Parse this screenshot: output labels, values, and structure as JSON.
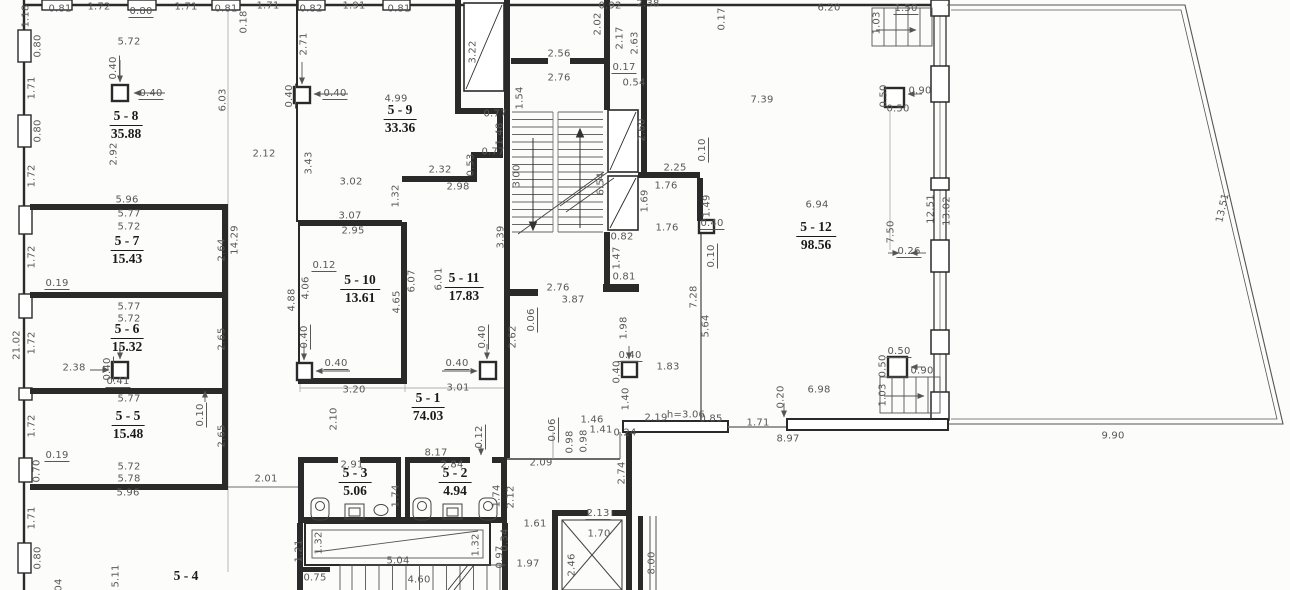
{
  "colors": {
    "wall": "#2a2a2a",
    "thin_line": "#777777",
    "dim_line": "#9a9a9a",
    "dim_text": "#585858",
    "room_text": "#1b1b1b",
    "paper": "#fcfcfa"
  },
  "rooms": [
    {
      "id": "5 - 8",
      "area": "35.88",
      "x": 126,
      "y": 117
    },
    {
      "id": "5 - 9",
      "area": "33.36",
      "x": 400,
      "y": 111
    },
    {
      "id": "5 - 7",
      "area": "15.43",
      "x": 127,
      "y": 242
    },
    {
      "id": "5 - 10",
      "area": "13.61",
      "x": 360,
      "y": 281
    },
    {
      "id": "5 - 11",
      "area": "17.83",
      "x": 464,
      "y": 279
    },
    {
      "id": "5 - 12",
      "area": "98.56",
      "x": 816,
      "y": 228
    },
    {
      "id": "5 - 6",
      "area": "15.32",
      "x": 127,
      "y": 330
    },
    {
      "id": "5 - 5",
      "area": "15.48",
      "x": 128,
      "y": 417
    },
    {
      "id": "5 - 1",
      "area": "74.03",
      "x": 428,
      "y": 399
    },
    {
      "id": "5 - 3",
      "area": "5.06",
      "x": 355,
      "y": 474
    },
    {
      "id": "5 - 2",
      "area": "4.94",
      "x": 455,
      "y": 474
    },
    {
      "id": "5 - 4",
      "area": "",
      "x": 186,
      "y": 577
    }
  ],
  "dimensions": [
    {
      "t": "1.18",
      "x": 26,
      "y": 16,
      "r": 1
    },
    {
      "t": "0.81",
      "x": 60,
      "y": 9
    },
    {
      "t": "1.72",
      "x": 99,
      "y": 7
    },
    {
      "t": "0.80",
      "x": 141,
      "y": 12,
      "u": 1
    },
    {
      "t": "1.71",
      "x": 186,
      "y": 7
    },
    {
      "t": "0.81",
      "x": 226,
      "y": 9
    },
    {
      "t": "0.18",
      "x": 244,
      "y": 22,
      "r": 1
    },
    {
      "t": "1.71",
      "x": 268,
      "y": 6
    },
    {
      "t": "0.82",
      "x": 311,
      "y": 9
    },
    {
      "t": "1.91",
      "x": 354,
      "y": 6
    },
    {
      "t": "0.81",
      "x": 399,
      "y": 9
    },
    {
      "t": "2.71",
      "x": 304,
      "y": 44,
      "r": 1
    },
    {
      "t": "5.72",
      "x": 129,
      "y": 42
    },
    {
      "t": "0.80",
      "x": 38,
      "y": 46,
      "r": 1
    },
    {
      "t": "0.40",
      "x": 114,
      "y": 68,
      "r": 1,
      "u": 1
    },
    {
      "t": "0.40",
      "x": 151,
      "y": 94,
      "u": 1
    },
    {
      "t": "1.71",
      "x": 32,
      "y": 88,
      "r": 1
    },
    {
      "t": "6.03",
      "x": 223,
      "y": 100,
      "r": 1
    },
    {
      "t": "0.40",
      "x": 290,
      "y": 96,
      "r": 1,
      "u": 1
    },
    {
      "t": "0.40",
      "x": 335,
      "y": 94,
      "u": 1
    },
    {
      "t": "4.99",
      "x": 396,
      "y": 99
    },
    {
      "t": "0.80",
      "x": 38,
      "y": 131,
      "r": 1
    },
    {
      "t": "2.92",
      "x": 114,
      "y": 154,
      "r": 1
    },
    {
      "t": "1.72",
      "x": 32,
      "y": 176,
      "r": 1
    },
    {
      "t": "2.12",
      "x": 264,
      "y": 154
    },
    {
      "t": "3.43",
      "x": 309,
      "y": 163,
      "r": 1
    },
    {
      "t": "3.02",
      "x": 351,
      "y": 182
    },
    {
      "t": "5.96",
      "x": 127,
      "y": 200
    },
    {
      "t": "5.77",
      "x": 129,
      "y": 214
    },
    {
      "t": "5.72",
      "x": 129,
      "y": 227
    },
    {
      "t": "3.07",
      "x": 350,
      "y": 216
    },
    {
      "t": "2.95",
      "x": 353,
      "y": 231
    },
    {
      "t": "1.32",
      "x": 396,
      "y": 196,
      "r": 1
    },
    {
      "t": "2.32",
      "x": 440,
      "y": 170
    },
    {
      "t": "2.98",
      "x": 458,
      "y": 187
    },
    {
      "t": "0.77",
      "x": 495,
      "y": 114
    },
    {
      "t": "1.48",
      "x": 500,
      "y": 134,
      "r": 1
    },
    {
      "t": "0.77",
      "x": 493,
      "y": 152
    },
    {
      "t": "0.53",
      "x": 471,
      "y": 165,
      "r": 1
    },
    {
      "t": "3.22",
      "x": 473,
      "y": 52,
      "r": 1
    },
    {
      "t": "1.54",
      "x": 520,
      "y": 98,
      "r": 1
    },
    {
      "t": "2.56",
      "x": 559,
      "y": 54
    },
    {
      "t": "2.76",
      "x": 559,
      "y": 78
    },
    {
      "t": "3.00",
      "x": 517,
      "y": 176,
      "r": 1
    },
    {
      "t": "6.54",
      "x": 601,
      "y": 184,
      "r": 1
    },
    {
      "t": "0.92",
      "x": 610,
      "y": 6
    },
    {
      "t": "2.02",
      "x": 598,
      "y": 24,
      "r": 1
    },
    {
      "t": "2.38",
      "x": 648,
      "y": 4
    },
    {
      "t": "2.17",
      "x": 620,
      "y": 38,
      "r": 1
    },
    {
      "t": "2.63",
      "x": 635,
      "y": 43,
      "r": 1
    },
    {
      "t": "0.17",
      "x": 624,
      "y": 68,
      "u": 1
    },
    {
      "t": "0.54",
      "x": 634,
      "y": 83
    },
    {
      "t": "2.60",
      "x": 642,
      "y": 130,
      "r": 1
    },
    {
      "t": "1.69",
      "x": 645,
      "y": 201,
      "r": 1
    },
    {
      "t": "2.25",
      "x": 675,
      "y": 168
    },
    {
      "t": "1.76",
      "x": 666,
      "y": 186
    },
    {
      "t": "1.76",
      "x": 667,
      "y": 228
    },
    {
      "t": "0.10",
      "x": 703,
      "y": 150,
      "r": 1,
      "u": 1
    },
    {
      "t": "1.49",
      "x": 707,
      "y": 206,
      "r": 1
    },
    {
      "t": "0.40",
      "x": 712,
      "y": 224,
      "u": 1
    },
    {
      "t": "0.10",
      "x": 712,
      "y": 256,
      "r": 1,
      "u": 1
    },
    {
      "t": "0.82",
      "x": 622,
      "y": 237
    },
    {
      "t": "1.47",
      "x": 617,
      "y": 258,
      "r": 1
    },
    {
      "t": "0.81",
      "x": 624,
      "y": 277
    },
    {
      "t": "2.76",
      "x": 558,
      "y": 288
    },
    {
      "t": "3.87",
      "x": 573,
      "y": 300
    },
    {
      "t": "0.06",
      "x": 532,
      "y": 320,
      "r": 1,
      "u": 1
    },
    {
      "t": "2.62",
      "x": 513,
      "y": 337,
      "r": 1
    },
    {
      "t": "7.28",
      "x": 694,
      "y": 297,
      "r": 1
    },
    {
      "t": "5.64",
      "x": 706,
      "y": 326,
      "r": 1
    },
    {
      "t": "1.98",
      "x": 624,
      "y": 328,
      "r": 1
    },
    {
      "t": "0.17",
      "x": 722,
      "y": 19,
      "r": 1
    },
    {
      "t": "6.20",
      "x": 829,
      "y": 8
    },
    {
      "t": "1.50",
      "x": 906,
      "y": 9,
      "u": 1
    },
    {
      "t": "1.03",
      "x": 877,
      "y": 23,
      "r": 1
    },
    {
      "t": "7.39",
      "x": 762,
      "y": 100
    },
    {
      "t": "0.50",
      "x": 884,
      "y": 96,
      "r": 1
    },
    {
      "t": "0.90",
      "x": 920,
      "y": 91
    },
    {
      "t": "0.50",
      "x": 898,
      "y": 109
    },
    {
      "t": "6.94",
      "x": 817,
      "y": 205
    },
    {
      "t": "7.50",
      "x": 891,
      "y": 232,
      "r": 1
    },
    {
      "t": "12.51",
      "x": 931,
      "y": 209,
      "r": 1
    },
    {
      "t": "13.02",
      "x": 947,
      "y": 211,
      "r": 1
    },
    {
      "t": "0.26",
      "x": 909,
      "y": 252,
      "u": 1
    },
    {
      "t": "13.51",
      "x": 1223,
      "y": 208,
      "r": -77
    },
    {
      "t": "0.19",
      "x": 57,
      "y": 284,
      "u": 1
    },
    {
      "t": "5.77",
      "x": 129,
      "y": 307
    },
    {
      "t": "5.72",
      "x": 129,
      "y": 319
    },
    {
      "t": "2.64",
      "x": 222,
      "y": 250,
      "r": 1
    },
    {
      "t": "14.29",
      "x": 235,
      "y": 240,
      "r": 1
    },
    {
      "t": "1.72",
      "x": 32,
      "y": 257,
      "r": 1
    },
    {
      "t": "21.02",
      "x": 17,
      "y": 345,
      "r": 1
    },
    {
      "t": "1.72",
      "x": 32,
      "y": 343,
      "r": 1
    },
    {
      "t": "2.38",
      "x": 74,
      "y": 368
    },
    {
      "t": "0.40",
      "x": 108,
      "y": 369,
      "r": 1,
      "u": 1
    },
    {
      "t": "0.41",
      "x": 118,
      "y": 382,
      "u": 1
    },
    {
      "t": "2.65",
      "x": 222,
      "y": 339,
      "r": 1
    },
    {
      "t": "0.12",
      "x": 324,
      "y": 266,
      "u": 1
    },
    {
      "t": "4.06",
      "x": 306,
      "y": 288,
      "r": 1
    },
    {
      "t": "4.88",
      "x": 292,
      "y": 300,
      "r": 1
    },
    {
      "t": "4.65",
      "x": 397,
      "y": 302,
      "r": 1
    },
    {
      "t": "6.07",
      "x": 412,
      "y": 281,
      "r": 1
    },
    {
      "t": "6.01",
      "x": 439,
      "y": 279,
      "r": 1
    },
    {
      "t": "3.39",
      "x": 501,
      "y": 237,
      "r": 1
    },
    {
      "t": "0.40",
      "x": 305,
      "y": 337,
      "r": 1,
      "u": 1
    },
    {
      "t": "0.40",
      "x": 336,
      "y": 364,
      "u": 1
    },
    {
      "t": "0.40",
      "x": 483,
      "y": 337,
      "r": 1,
      "u": 1
    },
    {
      "t": "0.40",
      "x": 457,
      "y": 364,
      "u": 1
    },
    {
      "t": "0.40",
      "x": 630,
      "y": 356,
      "u": 1
    },
    {
      "t": "0.40",
      "x": 617,
      "y": 372,
      "r": 1
    },
    {
      "t": "1.83",
      "x": 668,
      "y": 367
    },
    {
      "t": "3.20",
      "x": 354,
      "y": 390
    },
    {
      "t": "3.01",
      "x": 458,
      "y": 388
    },
    {
      "t": "2.10",
      "x": 334,
      "y": 419,
      "r": 1
    },
    {
      "t": "1.40",
      "x": 626,
      "y": 399,
      "r": 1
    },
    {
      "t": "5.77",
      "x": 129,
      "y": 399
    },
    {
      "t": "0.10",
      "x": 201,
      "y": 415,
      "r": 1,
      "u": 1
    },
    {
      "t": "2.65",
      "x": 222,
      "y": 436,
      "r": 1
    },
    {
      "t": "1.72",
      "x": 32,
      "y": 426,
      "r": 1
    },
    {
      "t": "0.19",
      "x": 57,
      "y": 456,
      "u": 1
    },
    {
      "t": "0.70",
      "x": 37,
      "y": 471,
      "r": 1
    },
    {
      "t": "5.72",
      "x": 129,
      "y": 467
    },
    {
      "t": "5.78",
      "x": 129,
      "y": 479
    },
    {
      "t": "5.96",
      "x": 128,
      "y": 493
    },
    {
      "t": "2.01",
      "x": 266,
      "y": 479
    },
    {
      "t": "1.46",
      "x": 592,
      "y": 420
    },
    {
      "t": "1.41",
      "x": 601,
      "y": 430
    },
    {
      "t": "0.24",
      "x": 625,
      "y": 433
    },
    {
      "t": "0.98",
      "x": 570,
      "y": 442,
      "r": 1
    },
    {
      "t": "0.98",
      "x": 584,
      "y": 441,
      "r": 1
    },
    {
      "t": "0.06",
      "x": 553,
      "y": 430,
      "r": 1,
      "u": 1
    },
    {
      "t": "2.19",
      "x": 656,
      "y": 418
    },
    {
      "t": "h=3.06",
      "x": 686,
      "y": 415
    },
    {
      "t": "0.85",
      "x": 711,
      "y": 419
    },
    {
      "t": "1.71",
      "x": 758,
      "y": 423
    },
    {
      "t": "8.97",
      "x": 788,
      "y": 439
    },
    {
      "t": "0.20",
      "x": 781,
      "y": 397,
      "r": 1
    },
    {
      "t": "6.98",
      "x": 819,
      "y": 390
    },
    {
      "t": "0.50",
      "x": 899,
      "y": 352,
      "u": 1
    },
    {
      "t": "0.50",
      "x": 883,
      "y": 366,
      "r": 1
    },
    {
      "t": "0.90",
      "x": 922,
      "y": 371
    },
    {
      "t": "1.03",
      "x": 883,
      "y": 395,
      "r": 1
    },
    {
      "t": "9.90",
      "x": 1113,
      "y": 436
    },
    {
      "t": "8.17",
      "x": 436,
      "y": 453
    },
    {
      "t": "0.12",
      "x": 480,
      "y": 437,
      "r": 1,
      "u": 1
    },
    {
      "t": "2.09",
      "x": 541,
      "y": 463
    },
    {
      "t": "2.91",
      "x": 352,
      "y": 465
    },
    {
      "t": "2.84",
      "x": 452,
      "y": 465
    },
    {
      "t": "1.74",
      "x": 396,
      "y": 496,
      "r": 1
    },
    {
      "t": "1.74",
      "x": 497,
      "y": 496,
      "r": 1
    },
    {
      "t": "2.12",
      "x": 511,
      "y": 497,
      "r": 1
    },
    {
      "t": "2.74",
      "x": 622,
      "y": 473,
      "r": 1
    },
    {
      "t": "1.61",
      "x": 535,
      "y": 524
    },
    {
      "t": "2.13",
      "x": 598,
      "y": 514,
      "u": 1
    },
    {
      "t": "1.70",
      "x": 599,
      "y": 534
    },
    {
      "t": "0.34",
      "x": 505,
      "y": 540,
      "r": 1
    },
    {
      "t": "0.97",
      "x": 500,
      "y": 557,
      "r": 1
    },
    {
      "t": "1.97",
      "x": 528,
      "y": 564
    },
    {
      "t": "2.46",
      "x": 572,
      "y": 565,
      "r": 1
    },
    {
      "t": "8.00",
      "x": 652,
      "y": 563,
      "r": 1
    },
    {
      "t": "1.32",
      "x": 319,
      "y": 543,
      "r": 1
    },
    {
      "t": "1.32",
      "x": 476,
      "y": 545,
      "r": 1
    },
    {
      "t": "1.21",
      "x": 299,
      "y": 551,
      "r": 1
    },
    {
      "t": "5.04",
      "x": 398,
      "y": 561
    },
    {
      "t": "0.75",
      "x": 315,
      "y": 578
    },
    {
      "t": "4.60",
      "x": 419,
      "y": 580
    },
    {
      "t": "1.71",
      "x": 32,
      "y": 518,
      "r": 1
    },
    {
      "t": "0.80",
      "x": 38,
      "y": 558,
      "r": 1
    },
    {
      "t": "5.11",
      "x": 116,
      "y": 576,
      "r": 1
    },
    {
      "t": "04",
      "x": 59,
      "y": 585,
      "r": 1
    }
  ]
}
